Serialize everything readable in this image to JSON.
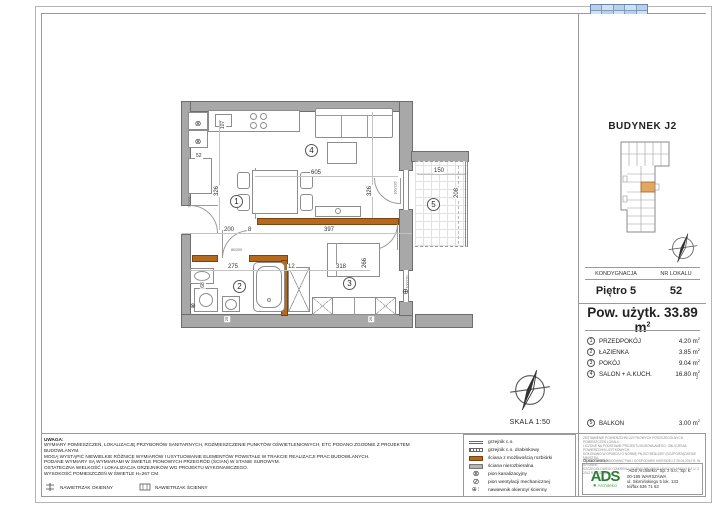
{
  "colors": {
    "removable_wall": "#b4691e",
    "structural_wall": "#b3b3b3",
    "unit_highlight": "#e2a763",
    "logo_green": "#2e7d36"
  },
  "right_panel": {
    "building_title": "BUDYNEK J2",
    "table": {
      "col1_header": "KONDYGNACJA",
      "col2_header": "NR LOKALU",
      "floor": "Piętro 5",
      "unit_no": "52"
    },
    "area_title": {
      "text": "Pow. użytk. 33.89 m",
      "sup": "2"
    },
    "rooms": [
      {
        "no": "1",
        "name": "PRZEDPOKÓJ",
        "area": "4.20 m",
        "sup": "2"
      },
      {
        "no": "2",
        "name": "ŁAZIENKA",
        "area": "3.85 m",
        "sup": "2"
      },
      {
        "no": "3",
        "name": "POKÓJ",
        "area": "9.04 m",
        "sup": "2"
      },
      {
        "no": "4",
        "name": "SALON + A.KUCH.",
        "area": "16.80 m",
        "sup": "2"
      },
      {
        "no": "5",
        "name": "BALKON",
        "area": "3.00 m",
        "sup": "2"
      }
    ],
    "stray_sup": "2",
    "fine_print": [
      "ZESTAWIENIE POWIERZCHNI UŻYTKOWYCH POSZCZEGÓLNYCH POMIESZCZEŃ LOKALU",
      "LICZONE NA PODSTAWIE PROJEKTU BUDOWLANEGO. OBLICZENIA POWIERZCHNI UŻYTKOWYCH",
      "DOKONANO W OPARCIU O NORMĘ PN-ISO 9836:1997 (ROZPORZĄDZENIE MINISTRA",
      "TRANSPORTU, BUDOWNICTWA I GOSPODARKI MORSKIEJ Z 25.04.2012 R. W SPRAWIE",
      "SZCZEGÓŁOWEGO ZAKRESU I FORMY PROJEKTU BUDOWLANEGO DZ.U. Z 2012 R. POZ. 462)."
    ],
    "credit": {
      "label": "Opracowanie:",
      "logo": "ADS",
      "logo_sub": "Architekci",
      "line1": "\"ADS Architekci\" Sp. z o.o., Sp. k.",
      "line2": "00-195 WARSZAWA",
      "line3": "ul. Słomińskiego 5 lok. 133",
      "line4": "tel/fax 636 71 63"
    }
  },
  "notes": {
    "title": "UWAGA:",
    "lines": [
      "WYMIARY POMIESZCZEŃ, LOKALIZACJĘ PRZYBORÓW SANITARNYCH, ROZMIESZCZENIE PUNKTÓW OŚWIETLENIOWYCH, ETC PODANO ZGODNIE Z PROJEKTEM",
      "BUDOWLANYM.",
      "MOGĄ WYSTĄPIĆ NIEWIELKIE RÓŻNICE WYMIARÓW I USYTUOWANIE ELEMENTÓW POWSTAŁE W TRAKCIE REALIZACJI PRAC BUDOWLANYCH.",
      "PODANE WYMIARY SĄ WYMIARAMI W ŚWIETLE PIONOWYCH PRZEGRÓD (ŚCIAN) W STANIE SUROWYM.",
      "OSTATECZNA WIELKOŚĆ I LOKALIZACJA GRZEJNIKÓW WG PROJEKTU WYKONAWCZEGO.",
      "WYSOKOŚĆ POMIESZCZEŃ W ŚWIETLE H=267 CM."
    ],
    "vent_okienny": "NAWIETRZAK OKIENNY",
    "vent_scienny": "NAWIETRZAK ŚCIENNY"
  },
  "legend": {
    "items": [
      {
        "symbol": "radiator",
        "label": "grzejnik c.o."
      },
      {
        "symbol": "radiator-ladder",
        "label": "grzejnik c.o. drabinkowy"
      },
      {
        "symbol": "wall-removable",
        "label": "ściana z możliwością rozbiórki"
      },
      {
        "symbol": "wall-structural",
        "label": "ściana nierozbieralna"
      },
      {
        "symbol": "sewage-stack",
        "label": "pion kanalizacyjny"
      },
      {
        "symbol": "mech-vent-stack",
        "label": "pion wentylacji mechanicznej"
      },
      {
        "symbol": "air-inlet",
        "label": "nawiewnik okienny/ ścienny"
      }
    ]
  },
  "scale": {
    "label": "SKALA 1:50"
  },
  "plan": {
    "room_labels": {
      "r1": "1",
      "r2": "2",
      "r3": "3",
      "r4": "4",
      "r5": "5"
    },
    "dims": {
      "d605": "605",
      "d326_left": "326",
      "d326_right": "326",
      "d107": "107",
      "d52": "52",
      "d200": "200",
      "d8": "8",
      "d397": "397",
      "d275": "275",
      "d12": "12",
      "d318": "318",
      "d266": "266",
      "d68": "68",
      "d150": "150",
      "d208": "208",
      "door_entry": "90/200",
      "door_bath": "80/200",
      "door_balcony": "160/220",
      "window_pokoj": "100/220",
      "d25a": "25",
      "d25b": "25"
    },
    "symbols": {
      "sewage": "⊗",
      "vent": "⊕"
    }
  }
}
